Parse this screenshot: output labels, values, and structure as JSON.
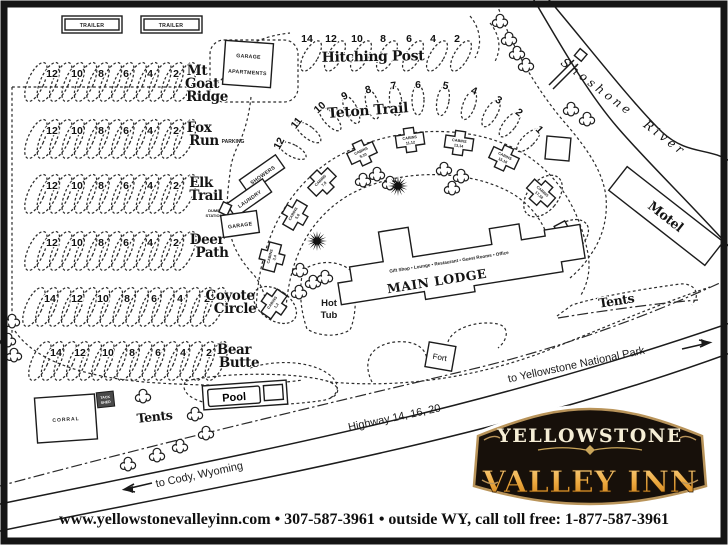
{
  "sign": {
    "line1": "YELLOWSTONE",
    "line2": "VALLEY INN"
  },
  "footer": {
    "contact": "www.yellowstonevalleyinn.com  •  307-587-3961  •  outside WY, call toll free: 1-877-587-3961"
  },
  "labels": {
    "trailer": "TRAILER",
    "garage_apartments": [
      "GARAGE",
      "APARTMENTS"
    ],
    "parking": "PARKING",
    "showers": "SHOWERS",
    "laundry": "LAUNDRY",
    "dump_station": [
      "DUMP",
      "STATION"
    ],
    "garage": "GARAGE",
    "main_lodge": "MAIN LODGE",
    "main_lodge_services": "Gift Shop • Lounge • Restaurant • Guest Rooms • Office",
    "hot_tub": [
      "Hot",
      "Tub"
    ],
    "pool": "Pool",
    "fort": "Fort",
    "corral": "CORRAL",
    "tack_shed": [
      "TACK",
      "SHED"
    ],
    "tents_left": "Tents",
    "tents_right": "Tents",
    "motel": "Motel",
    "river": "Shoshone River",
    "highway": "Highway 14, 16, 20",
    "to_cody": "to Cody, Wyoming",
    "to_yellowstone": "to Yellowstone National Park"
  },
  "camp_rows": [
    {
      "name": [
        "Mt",
        "Goat",
        "Ridge"
      ],
      "sites": [
        12,
        10,
        8,
        6,
        4,
        2
      ]
    },
    {
      "name": [
        "Fox",
        "Run"
      ],
      "sites": [
        12,
        10,
        8,
        6,
        4,
        2
      ]
    },
    {
      "name": [
        "Elk",
        "Trail"
      ],
      "sites": [
        12,
        10,
        8,
        6,
        4,
        2
      ]
    },
    {
      "name": [
        "Deer",
        "Path"
      ],
      "sites": [
        12,
        10,
        8,
        6,
        4,
        2
      ]
    },
    {
      "name": [
        "Coyote",
        "Circle"
      ],
      "sites": [
        14,
        12,
        10,
        8,
        6,
        4,
        2
      ]
    },
    {
      "name": [
        "Bear",
        "Butte"
      ],
      "sites": [
        14,
        12,
        10,
        8,
        6,
        4,
        2
      ]
    }
  ],
  "hitching_post": {
    "label": "Hitching Post",
    "sites": [
      14,
      12,
      10,
      8,
      6,
      4,
      2
    ]
  },
  "teton_trail": {
    "label": "Teton Trail",
    "sites": [
      12,
      11,
      10,
      9,
      8,
      7,
      6,
      5,
      4,
      3,
      2,
      1
    ]
  },
  "cabins": [
    "CABINS 1,2",
    "CABINS 3,4",
    "CABINS 5,6",
    "CABINS 7,8",
    "CABINS 9,10",
    "CABINS 11,12",
    "CABINS 13,14",
    "CABINS 15,16",
    "CABINS 17,18",
    "CABINS 19,20"
  ],
  "colors": {
    "ink": "#1c1c1c",
    "sign_bg": "#17100a",
    "sign_border": "#b9945a",
    "sign_cream": "#f6eed6",
    "sign_gold_light": "#f8d084",
    "sign_gold_mid": "#eda93f",
    "sign_gold_dark": "#c97b14"
  }
}
